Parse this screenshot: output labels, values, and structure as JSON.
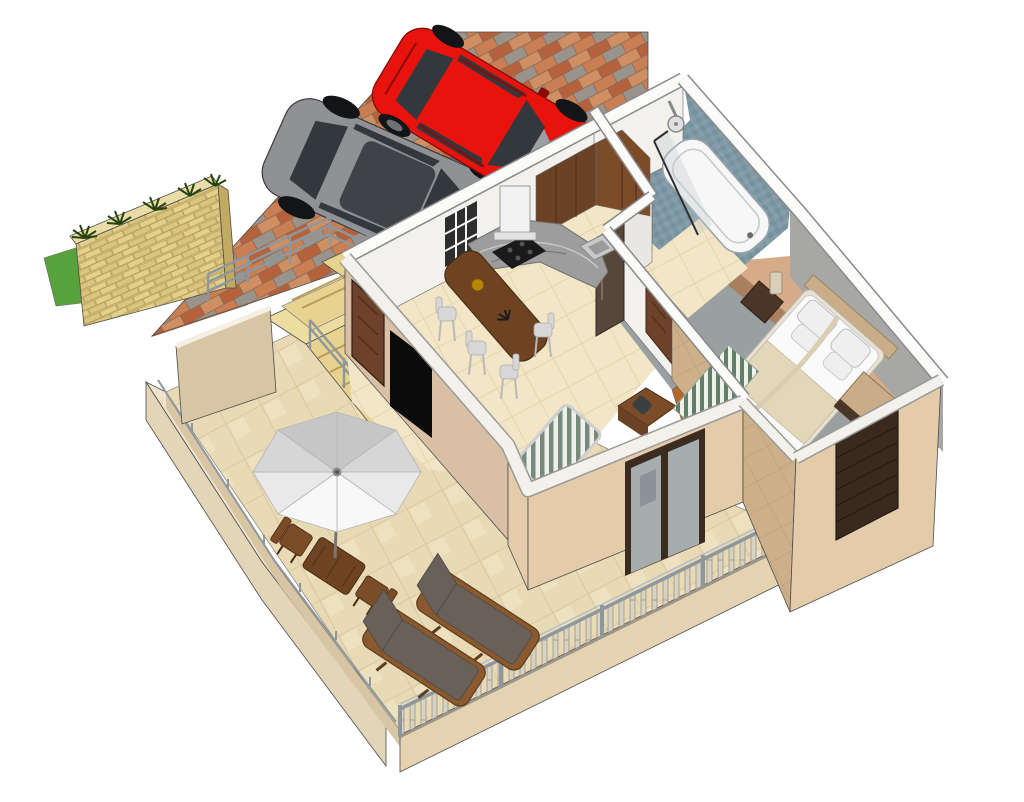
{
  "meta": {
    "title": "3D floor plan render",
    "description": "Isometric 3D SketchUp-style render of a one-bedroom apartment: brick driveway with a red hatchback and a grey car, sandstone garden wall with plants, staircase with metal railings, open-plan kitchen and dining area, blue-tiled bathroom with bathtub and shower, bedroom with double bed, and a large tiled terrace with parasol, outdoor dining set, two sun loungers and balustrade railings."
  },
  "rooms": [
    "driveway",
    "garden-wall",
    "staircase",
    "kitchen",
    "dining-area",
    "bathroom",
    "hallway",
    "bedroom",
    "living-area",
    "terrace",
    "balcony"
  ],
  "objects": [
    "red-hatchback-car",
    "grey-car",
    "stone-garden-wall",
    "agave-plants",
    "grass-patch",
    "metal-stair-railing",
    "front-door",
    "wall-tv",
    "kitchen-cabinets",
    "extractor-hood",
    "cooktop",
    "marble-counter",
    "kitchen-sink",
    "fridge",
    "kitchen-window",
    "dining-bar-table",
    "bar-stools",
    "bathtub",
    "shower-screen",
    "shower-head",
    "hall-door",
    "double-bed",
    "headboard",
    "nightstand",
    "lamp",
    "striped-rug",
    "dresser",
    "daybed",
    "desk",
    "patio-glass-door",
    "shuttered-window",
    "parasol",
    "outdoor-table",
    "outdoor-chairs",
    "sun-loungers",
    "terrace-balustrade",
    "parapet-wall"
  ],
  "palette": {
    "bg": "#ffffff",
    "brick_a": "#b5613c",
    "brick_b": "#c97f53",
    "brick_c": "#99938b",
    "brick_d": "#cf8f62",
    "brick_mortar": "#8a6a55",
    "stone": "#d9c480",
    "stone_light": "#e2d08c",
    "stone_top": "#e9dca6",
    "stone_end": "#c2ab61",
    "stone_mortar": "#b59c55",
    "grass": "#58a23c",
    "plant": "#26420f",
    "step": "#e7d28f",
    "step_edge": "#b99c5a",
    "landing": "#eedda0",
    "railing": "#8f979e",
    "railing_light": "#b9bfc4",
    "car_red": "#e8130d",
    "car_red_trim": "#8a0a06",
    "car_gray": "#8f9194",
    "car_gray_trim": "#5e6063",
    "glass_dark": "#33383d",
    "tire": "#121417",
    "interior_gray": "#9aa0a4",
    "wall_band": "#fbfbfa",
    "wall_under": "#8a8a8a",
    "wall_face": "#f3f1ee",
    "wall_face2": "#e9e7e3",
    "beige_wall": "#d9c0a4",
    "beige_wall2": "#e4cba9",
    "tan_tiles": "#cdb089",
    "floor_tile": "#f2e6c6",
    "floor_line": "#e0d0a8",
    "terrace_tile": "#e9dab6",
    "terrace_line": "#d6c49a",
    "parapet_top": "#eee3cc",
    "parapet_outer": "#e3d5b8",
    "parapet_inner": "#d8c5a3",
    "fascia": "#e5d2b0",
    "baluster": "#d8d2c2",
    "baluster_edge": "#9a948a",
    "bath_tile": "#7f98a3",
    "bath_a": "#71909c",
    "bath_b": "#8ba3ad",
    "tub": "#f7f7f7",
    "glass_pane": "#b9c4c9",
    "wood_dark": "#6b4226",
    "wood_mid": "#7c4b28",
    "wood_light": "#9a6a3a",
    "wood_floor": "#b5662a",
    "counter": "#9d9d9d",
    "marble_light": "#c9c9c9",
    "marble_dark": "#707070",
    "cooktop": "#1a1a1a",
    "hood": "#f2f2f2",
    "fridge": "#57473a",
    "stool": "#d7d7d7",
    "stool_leg": "#b9b9b9",
    "table_wood": "#6e4322",
    "bed": "#fafafa",
    "blanket": "#e3d7ba",
    "pillow": "#efefef",
    "headboard": "#c9ad88",
    "nightstand": "#4a3526",
    "lamp": "#d9cfb8",
    "mat_a": "#5f8066",
    "mat_b": "#eef0ea",
    "stripe_a": "#7a8a7a",
    "stripe_b": "#eef0ea",
    "tv": "#0b0b0b",
    "door_brown": "#6e422a",
    "door_dark": "#3c2b20",
    "shutter": "#3a2a1e",
    "umb1": "#f8f8f8",
    "umb2": "#e9e9e9",
    "umb3": "#d6d6d6",
    "umb4": "#c6c6c6",
    "umb_pole": "#777777",
    "lounger": "#696159",
    "lounger_frame": "#8a5a2e",
    "gray_floor": "#9aa0a2",
    "gray_wall": "#a7a7a5",
    "edge": "#4d4d4d"
  }
}
